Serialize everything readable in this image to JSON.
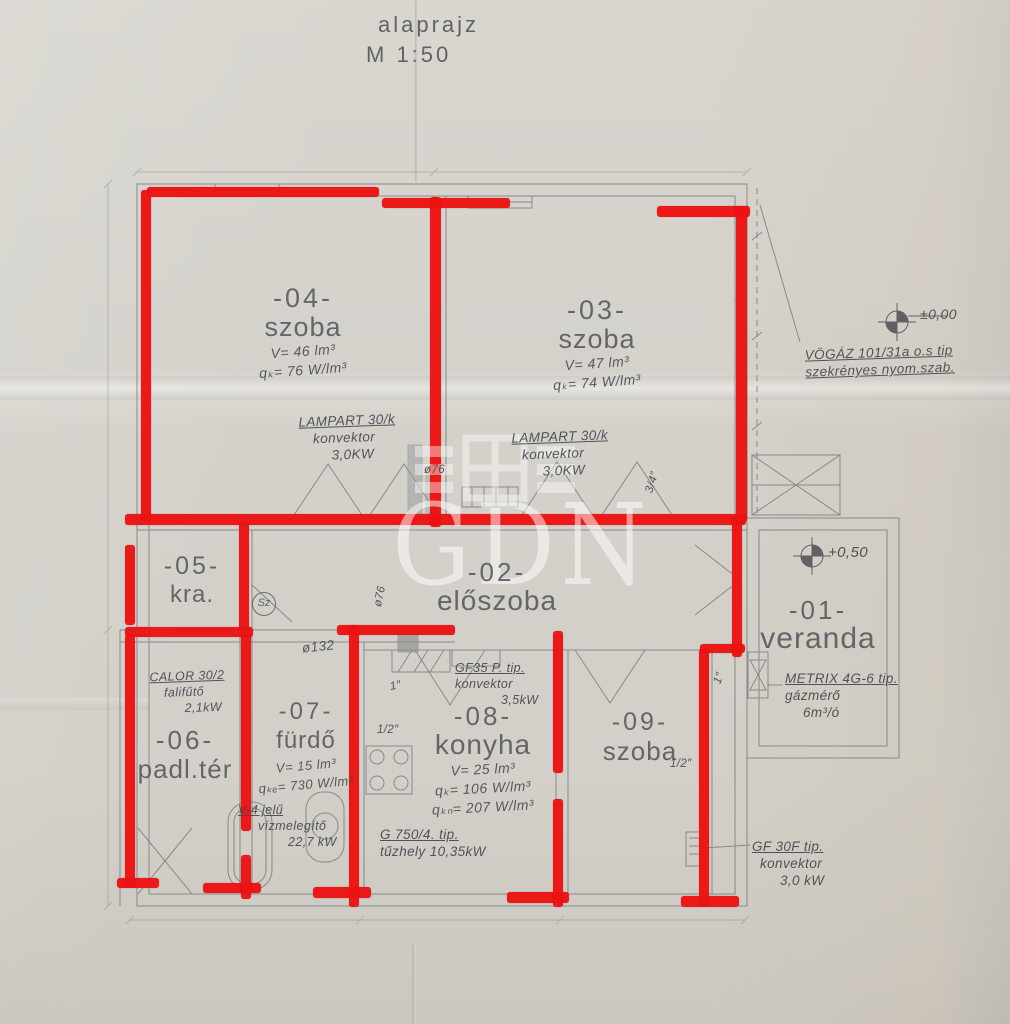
{
  "colors": {
    "paper": "#d3d1ca",
    "drawing_ink": "#6e7278",
    "printed_label": "#54575d",
    "pencil": "#42464e",
    "marker_red": "#ee1212",
    "watermark_white": "#ffffff"
  },
  "title": {
    "name": "alaprajz",
    "scale": "M 1:50"
  },
  "watermark": {
    "text": "GDN"
  },
  "rooms": [
    {
      "number": "-04-",
      "label": "szoba",
      "volume": "V= 46 lm³",
      "heat": "qₖ= 76 W/lm³"
    },
    {
      "number": "-03-",
      "label": "szoba",
      "volume": "V= 47 lm³",
      "heat": "qₖ= 74 W/lm³"
    },
    {
      "number": "-05-",
      "label": "kra."
    },
    {
      "number": "-02-",
      "label": "előszoba"
    },
    {
      "number": "-01-",
      "label": "veranda"
    },
    {
      "number": "-06-",
      "label": "padl.tér"
    },
    {
      "number": "-07-",
      "label": "fürdő",
      "volume": "V= 15 lm³",
      "heat": "qₖₑ= 730 W/lm³"
    },
    {
      "number": "-08-",
      "label": "konyha",
      "volume": "V= 25 lm³",
      "heat": "qₖ= 106 W/lm³",
      "heat2": "qₖₙ= 207 W/lm³"
    },
    {
      "number": "-09-",
      "label": "szoba"
    }
  ],
  "annotations": {
    "lampart_left": {
      "line1": "LAMPART 30/k",
      "line2": "konvektor",
      "line3": "3,0KW"
    },
    "lampart_right": {
      "line1": "LAMPART 30/k",
      "line2": "konvektor",
      "line3": "3,0KW"
    },
    "vogaz": {
      "line1": "VÖGÁZ 101/31a o.s tip",
      "line2": "szekrényes nyom.szab."
    },
    "metrix": {
      "line1": "METRIX 4G-6 tip.",
      "line2": "gázmérő",
      "line3": "6m³/ó"
    },
    "calor": {
      "line1": "CALOR 30/2",
      "line2": "falifűtő",
      "line3": "2,1kW"
    },
    "gf35": {
      "line1": "GF35 P. tip.",
      "line2": "konvektor",
      "line3": "3,5kW"
    },
    "g750": {
      "line1": "G 750/4. tip.",
      "line2": "tűzhely 10,35kW"
    },
    "v4": {
      "line1": "V-4 jelű",
      "line2": "vízmelegítő",
      "line3": "22,7 kW"
    },
    "gf30": {
      "line1": "GF 30F tip.",
      "line2": "konvektor",
      "line3": "3,0 kW"
    }
  },
  "elevations": {
    "main": "±0,00",
    "veranda": "+0,50"
  },
  "pipe_labels": {
    "phi76": "ø76",
    "phi76_b": "ø76",
    "phi132": "ø132",
    "half_a": "1/2″",
    "half_b": "1/2″",
    "one_a": "1″",
    "one_b": "1″",
    "threequarter": "3/4″",
    "sz": "Sz"
  }
}
